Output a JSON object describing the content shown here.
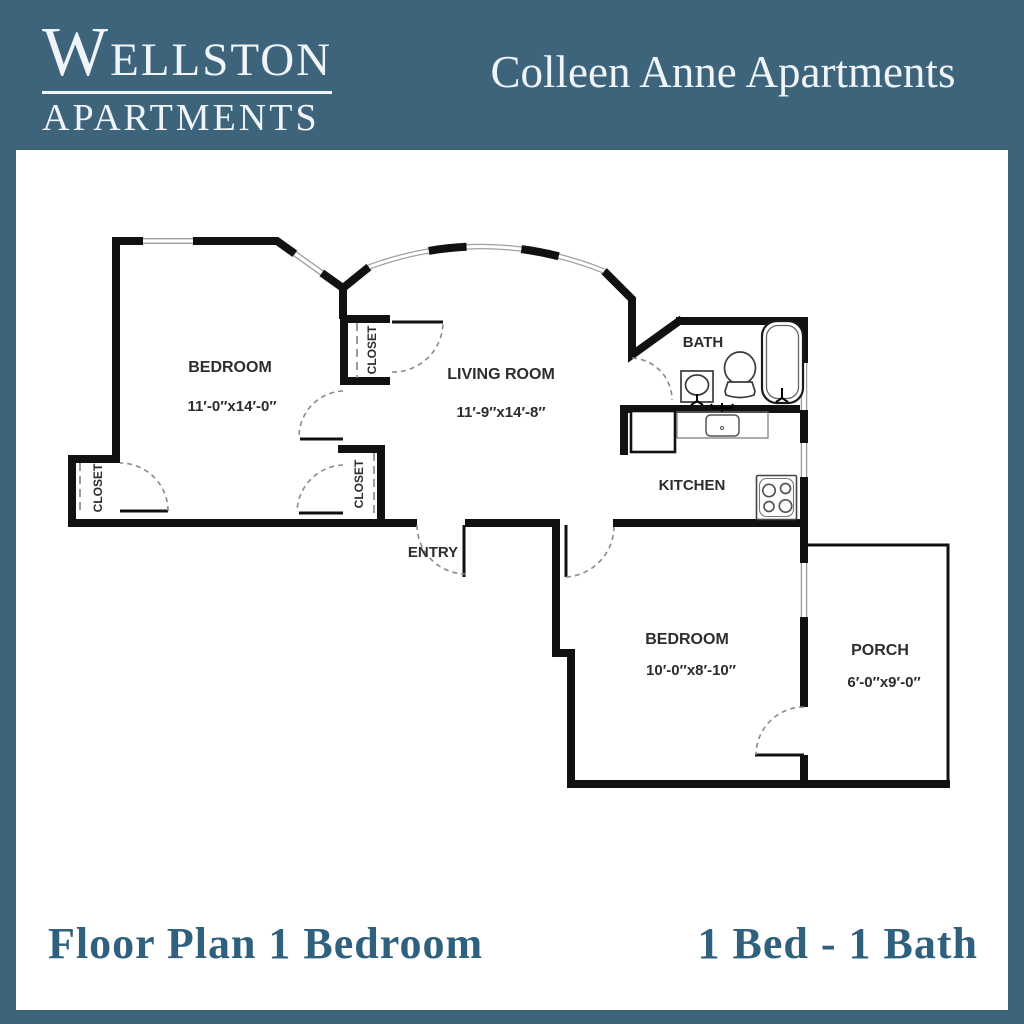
{
  "header": {
    "logo": {
      "line1": "WELLSTON",
      "line2": "APARTMENTS"
    },
    "title": "Colleen Anne Apartments"
  },
  "footer": {
    "left": "Floor Plan 1 Bedroom",
    "right": "1 Bed - 1 Bath"
  },
  "colors": {
    "frame_teal": "#3e647c",
    "panel_white": "#ffffff",
    "wall_black": "#111111",
    "label_gray": "#2d2d2d",
    "footer_teal": "#2f617f",
    "logo_white": "#eef4f8"
  },
  "floor_plan": {
    "rooms": [
      {
        "name": "BEDROOM",
        "dims": "11′-0″x14′-0″"
      },
      {
        "name": "LIVING ROOM",
        "dims": "11′-9″x14′-8″"
      },
      {
        "name": "BATH",
        "dims": ""
      },
      {
        "name": "KITCHEN",
        "dims": ""
      },
      {
        "name": "ENTRY",
        "dims": ""
      },
      {
        "name": "BEDROOM",
        "dims": "10′-0″x8′-10″"
      },
      {
        "name": "PORCH",
        "dims": "6′-0″x9′-0″"
      }
    ],
    "closets": [
      {
        "label": "CLOSET"
      },
      {
        "label": "CLOSET"
      },
      {
        "label": "CLOSET"
      }
    ],
    "fixtures": [
      "bathtub",
      "toilet",
      "bathroom-sink",
      "kitchen-counter",
      "kitchen-sink",
      "refrigerator",
      "stove"
    ]
  }
}
